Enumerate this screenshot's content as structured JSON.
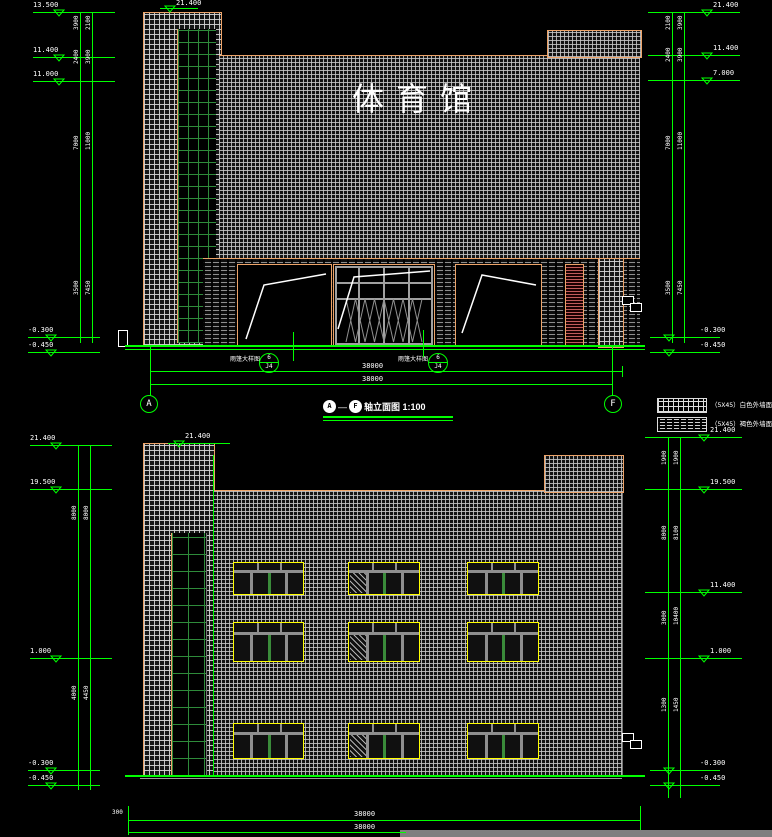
{
  "colors": {
    "green": "#00FF00",
    "white": "#FFFFFF",
    "orange": "#EDA368",
    "grid_gray": "#C8C8C8",
    "brick_gray": "#8F8F8F",
    "glass_green": "#2E8B3A",
    "louver_red": "#C25B5B",
    "window_yellow": "#FFFF00",
    "mullion_gray": "#8F8F8F",
    "ground_gray": "#9A9A9A",
    "bar_gray": "#7F7F7F"
  },
  "elevation1": {
    "building_title": "体育馆",
    "axis_start": "A",
    "axis_end": "F",
    "axis_dash": "—",
    "title": "轴立面图 1:100",
    "overall_dim": "38000",
    "canopy_note": "雨篷大样图",
    "detail_top": "6",
    "detail_bottom": "J4"
  },
  "elevation2": {
    "overall_dim": "38000",
    "left_dim": "300"
  },
  "legend": {
    "items": [
      {
        "name": "white-tile-swatch",
        "label": "（5X45）白色外墙面砖（白缝勾缝）"
      },
      {
        "name": "brown-tile-swatch",
        "label": "（5X45）褐色外墙面砖（白缝勾缝）"
      }
    ]
  },
  "layout": {
    "markers": [
      [
        33,
        12,
        82,
        53,
        "13.500",
        33,
        2
      ],
      [
        160,
        8,
        38,
        164,
        "21.400",
        176,
        0
      ],
      [
        33,
        57,
        82,
        53,
        "11.400",
        33,
        47
      ],
      [
        33,
        81,
        82,
        53,
        "11.000",
        33,
        71
      ],
      [
        28,
        337,
        72,
        45,
        "-0.300",
        28,
        327
      ],
      [
        28,
        352,
        72,
        45,
        "-0.450",
        28,
        342
      ],
      [
        648,
        12,
        92,
        701,
        "21.400",
        713,
        2
      ],
      [
        648,
        55,
        92,
        701,
        "11.400",
        713,
        45
      ],
      [
        648,
        80,
        92,
        701,
        "7.000",
        713,
        70
      ],
      [
        650,
        337,
        70,
        663,
        "-0.300",
        700,
        327
      ],
      [
        650,
        352,
        70,
        663,
        "-0.450",
        700,
        342
      ],
      [
        168,
        443,
        62,
        173,
        "21.400",
        185,
        433
      ],
      [
        30,
        445,
        82,
        50,
        "21.400",
        30,
        435
      ],
      [
        30,
        489,
        82,
        50,
        "19.500",
        30,
        479
      ],
      [
        30,
        658,
        82,
        50,
        "1.000",
        30,
        648
      ],
      [
        28,
        770,
        72,
        45,
        "-0.300",
        28,
        760
      ],
      [
        28,
        785,
        72,
        45,
        "-0.450",
        28,
        775
      ],
      [
        645,
        437,
        97,
        698,
        "21.400",
        710,
        427
      ],
      [
        645,
        489,
        97,
        698,
        "19.500",
        710,
        479
      ],
      [
        645,
        592,
        97,
        698,
        "11.400",
        710,
        582
      ],
      [
        645,
        658,
        97,
        698,
        "1.000",
        710,
        648
      ],
      [
        650,
        770,
        70,
        663,
        "-0.300",
        700,
        760
      ],
      [
        650,
        785,
        70,
        663,
        "-0.450",
        700,
        775
      ]
    ],
    "rails": [
      [
        80,
        12,
        343
      ],
      [
        92,
        12,
        343
      ],
      [
        672,
        12,
        343
      ],
      [
        684,
        12,
        343
      ],
      [
        78,
        445,
        790
      ],
      [
        90,
        445,
        790
      ],
      [
        668,
        437,
        798
      ],
      [
        680,
        437,
        798
      ],
      [
        150,
        345,
        396
      ],
      [
        612,
        345,
        396
      ],
      [
        622,
        366,
        377
      ],
      [
        293,
        332,
        361
      ],
      [
        423,
        330,
        357
      ],
      [
        213,
        455,
        775
      ],
      [
        128,
        806,
        835
      ],
      [
        640,
        806,
        830
      ]
    ],
    "hlines": [
      [
        125,
        345,
        520,
        2,
        "#00FF00"
      ],
      [
        125,
        349,
        520,
        1,
        "#00FF00"
      ],
      [
        150,
        371,
        472,
        1,
        "#00FF00"
      ],
      [
        150,
        384,
        462,
        1,
        "#00FF00"
      ],
      [
        125,
        775,
        520,
        2,
        "#00FF00"
      ],
      [
        140,
        778,
        482,
        1,
        "#9A9A9A"
      ],
      [
        128,
        820,
        512,
        1,
        "#00FF00"
      ],
      [
        128,
        832,
        278,
        1,
        "#00FF00"
      ],
      [
        323,
        416,
        130,
        2,
        "#00FF00"
      ],
      [
        323,
        420,
        130,
        1,
        "#00FF00"
      ]
    ],
    "dim_texts": [
      [
        74,
        30,
        "3900",
        1
      ],
      [
        86,
        30,
        "2100",
        1
      ],
      [
        74,
        64,
        "2400",
        1
      ],
      [
        86,
        64,
        "3900",
        1
      ],
      [
        74,
        150,
        "7000",
        1
      ],
      [
        86,
        150,
        "11000",
        1
      ],
      [
        74,
        295,
        "3500",
        1
      ],
      [
        86,
        295,
        "7450",
        1
      ],
      [
        666,
        30,
        "2100",
        1
      ],
      [
        678,
        30,
        "3900",
        1
      ],
      [
        666,
        62,
        "2400",
        1
      ],
      [
        678,
        62,
        "3900",
        1
      ],
      [
        666,
        150,
        "7000",
        1
      ],
      [
        678,
        150,
        "11000",
        1
      ],
      [
        666,
        295,
        "3500",
        1
      ],
      [
        678,
        295,
        "7450",
        1
      ],
      [
        72,
        520,
        "8000",
        1
      ],
      [
        84,
        520,
        "8000",
        1
      ],
      [
        72,
        700,
        "4000",
        1
      ],
      [
        84,
        700,
        "4450",
        1
      ],
      [
        662,
        465,
        "1900",
        1
      ],
      [
        674,
        465,
        "1900",
        1
      ],
      [
        662,
        540,
        "8000",
        1
      ],
      [
        674,
        540,
        "8100",
        1
      ],
      [
        662,
        625,
        "3000",
        1
      ],
      [
        674,
        625,
        "10400",
        1
      ],
      [
        662,
        712,
        "1300",
        1
      ],
      [
        674,
        712,
        "1450",
        1
      ],
      [
        112,
        810,
        "300",
        0
      ]
    ],
    "windows": [
      [
        233,
        562,
        69,
        31,
        0
      ],
      [
        348,
        562,
        70,
        31,
        1
      ],
      [
        467,
        562,
        70,
        31,
        0
      ],
      [
        233,
        622,
        69,
        38,
        0
      ],
      [
        348,
        622,
        70,
        38,
        1
      ],
      [
        467,
        622,
        70,
        38,
        0
      ],
      [
        233,
        723,
        69,
        34,
        0
      ],
      [
        348,
        723,
        70,
        34,
        1
      ],
      [
        467,
        723,
        70,
        34,
        0
      ]
    ]
  }
}
